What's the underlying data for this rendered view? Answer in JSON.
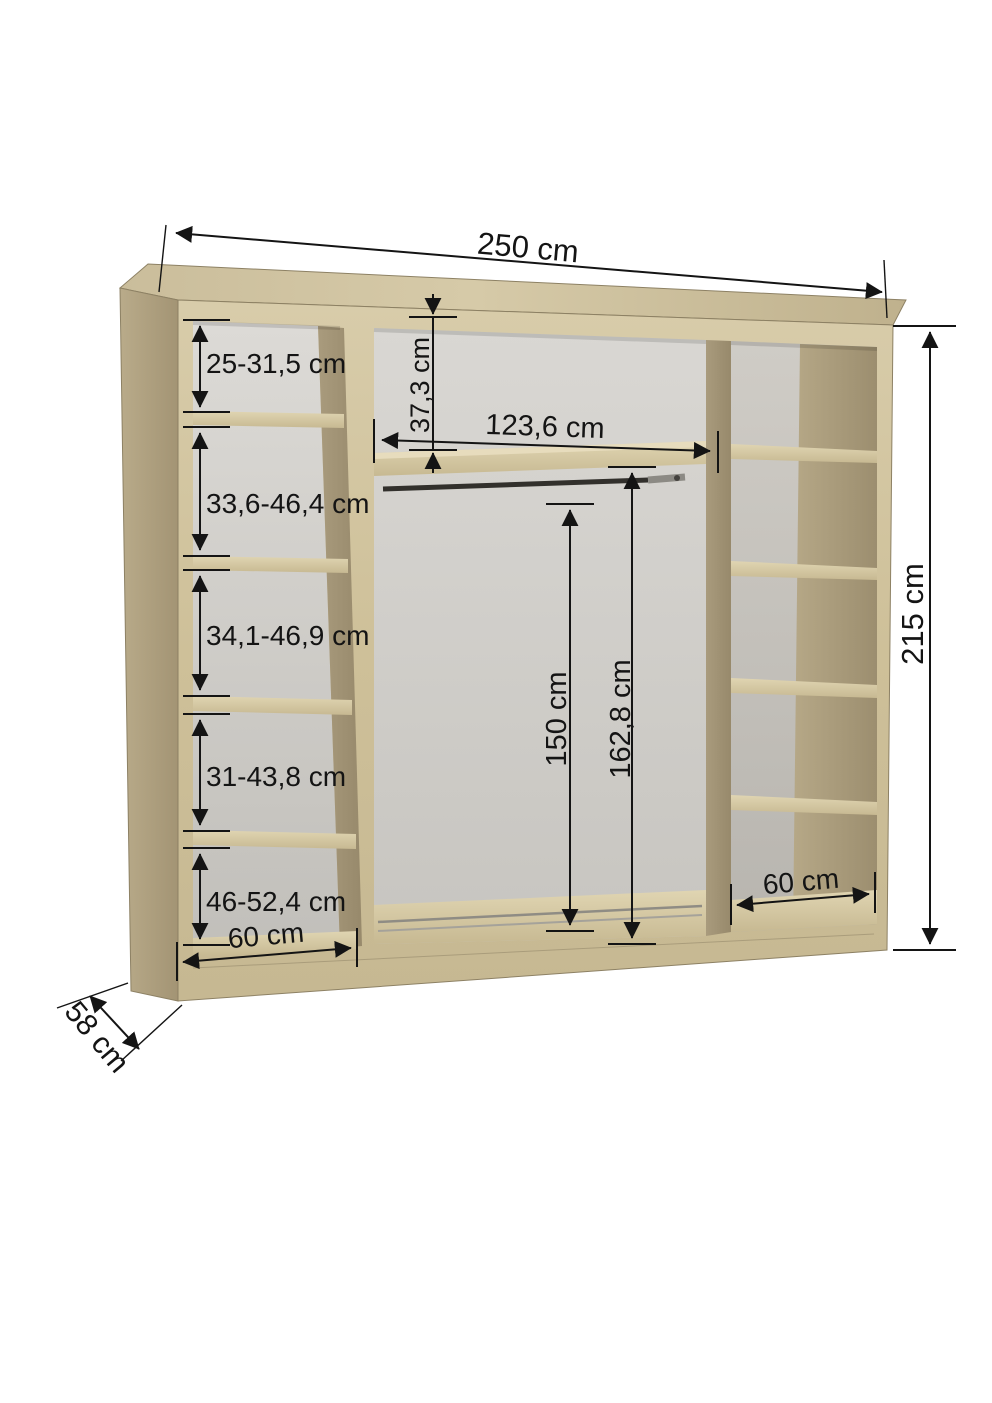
{
  "diagram": {
    "title": "wardrobe-interior-dimensions",
    "unit": "cm",
    "labels": {
      "width": "250 cm",
      "height": "215 cm",
      "depth": "58 cm",
      "top_gap": "37,3 cm",
      "middle_inner_width": "123,6 cm",
      "rail_height": "150 cm",
      "middle_inner_height": "162,8 cm",
      "left_section_1": "25-31,5 cm",
      "left_section_2": "33,6-46,4 cm",
      "left_section_3": "34,1-46,9 cm",
      "left_section_4": "31-43,8 cm",
      "left_section_5": "46-52,4 cm",
      "left_bottom_width": "60 cm",
      "right_bottom_width": "60 cm"
    },
    "colors": {
      "wood_front": "#d3c6a3",
      "wood_side": "#b1a281",
      "wood_divider": "#a4967a",
      "interior_grey": "#d2d0cb",
      "dimension": "#141414",
      "background": "#ffffff"
    }
  }
}
